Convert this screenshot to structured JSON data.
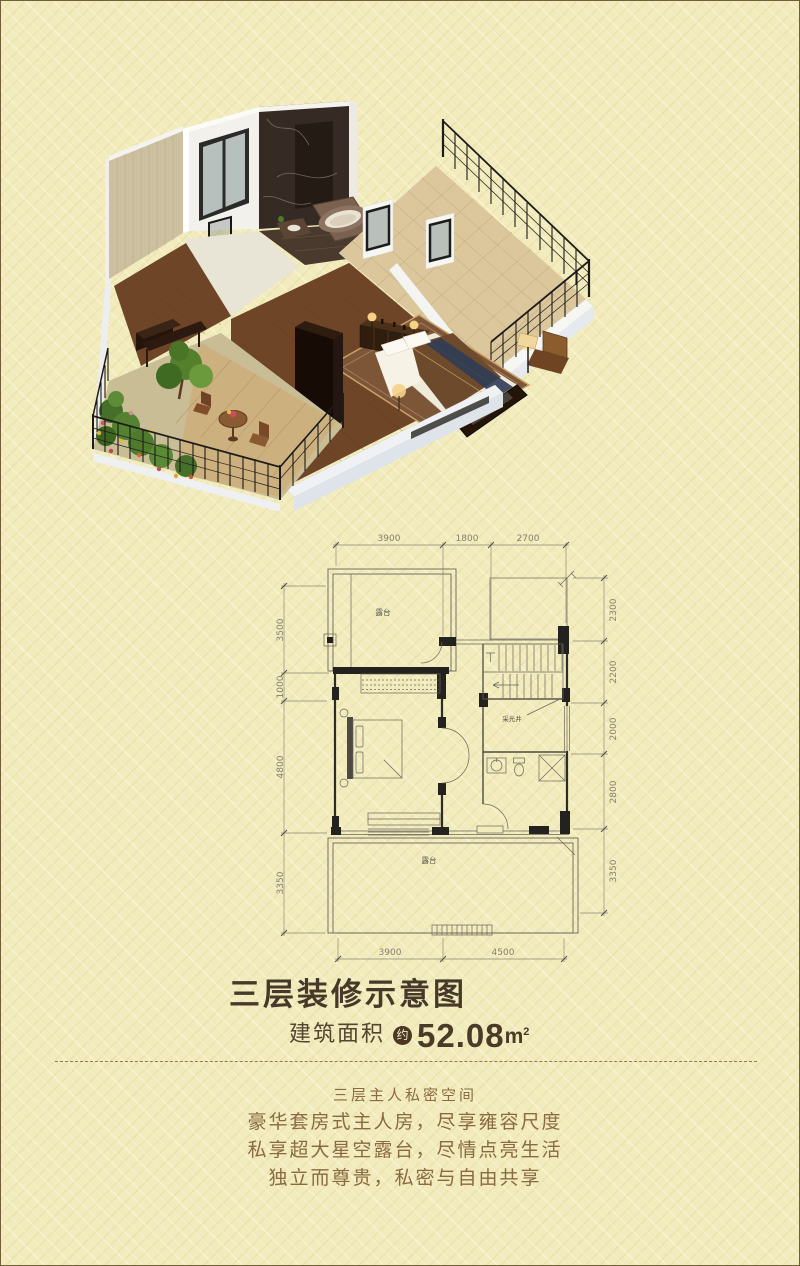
{
  "page": {
    "background": "#f2ebbc",
    "border_color": "#6f6038"
  },
  "title": {
    "text": "三层装修示意图",
    "color": "#46392a"
  },
  "area": {
    "label": "建筑面积",
    "badge": "约",
    "value": "52.08",
    "unit": "m",
    "unit_sup": "2"
  },
  "description": {
    "color": "#8a6a42",
    "lines": [
      "三层主人私密空间",
      "豪华套房式主人房，尽享雍容尺度",
      "私享超大星空露台，尽情点亮生活",
      "独立而尊贵，私密与自由共享"
    ]
  },
  "floorplan": {
    "dim_top": [
      "3900",
      "1800",
      "2700"
    ],
    "dim_bottom": [
      "3900",
      "4500"
    ],
    "dim_left": [
      "3500",
      "1000",
      "4800",
      "3350"
    ],
    "dim_right": [
      "2300",
      "2200",
      "2000",
      "2800",
      "3350"
    ],
    "rooms": {
      "terrace_top": "露台",
      "terrace_bottom": "露台",
      "light_well": "采光井"
    }
  }
}
